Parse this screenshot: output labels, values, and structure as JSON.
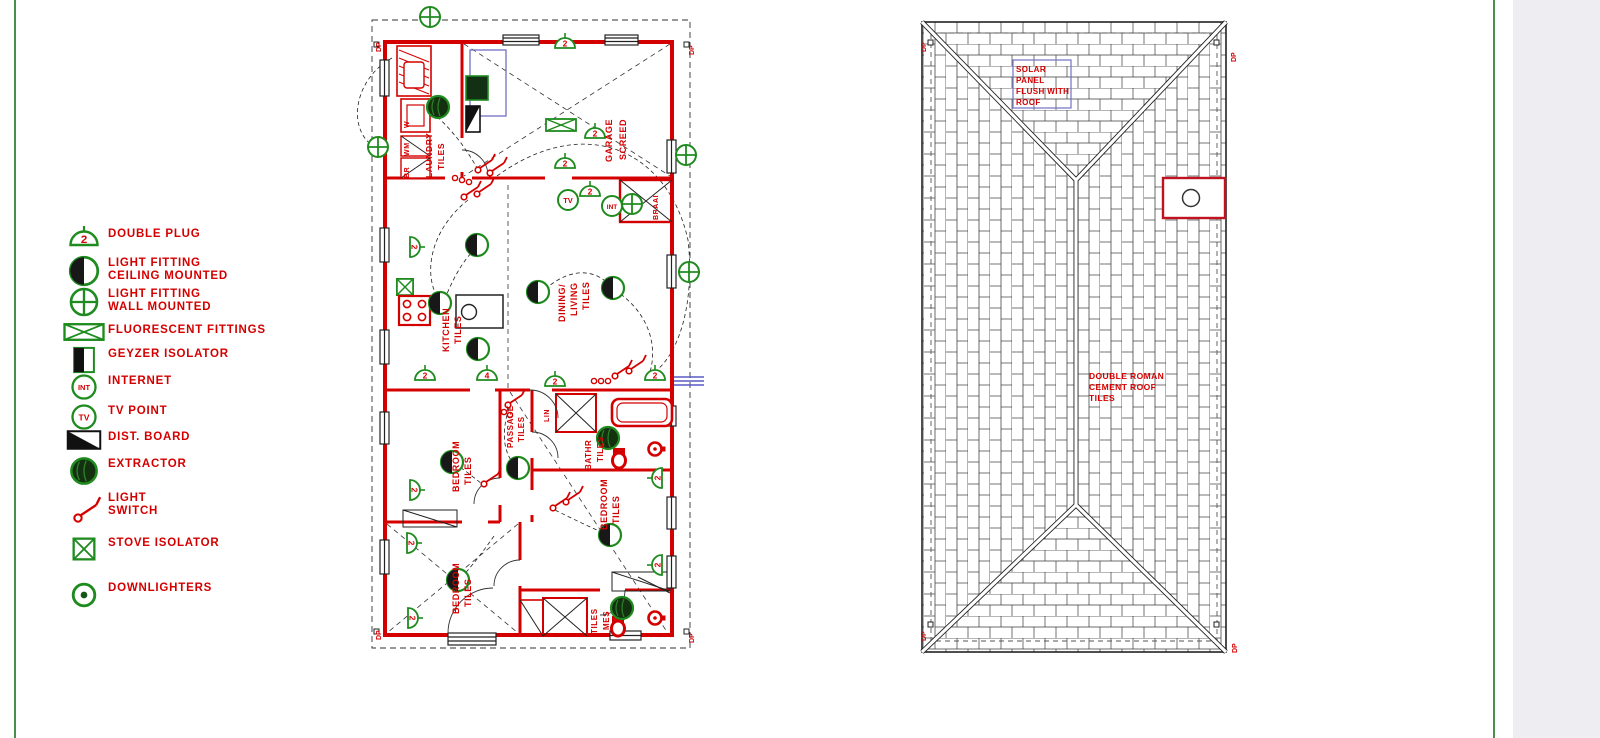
{
  "page": {
    "background": "#ffffff",
    "right_panel_color": "#ededf2",
    "guide_line_color": "#4c8c4c"
  },
  "colors": {
    "red": "#d40000",
    "green": "#1f8b1f",
    "blue": "#7070c0",
    "black": "#222222"
  },
  "legend": {
    "items": [
      {
        "name": "double-plug",
        "label": "DOUBLE PLUG",
        "symbol": "2"
      },
      {
        "name": "light-fitting-ceiling",
        "label": "LIGHT FITTING\nCEILING MOUNTED"
      },
      {
        "name": "light-fitting-wall",
        "label": "LIGHT FITTING\nWALL MOUNTED"
      },
      {
        "name": "fluorescent-fittings",
        "label": "FLUORESCENT FITTINGS"
      },
      {
        "name": "geyzer-isolator",
        "label": "GEYZER ISOLATOR"
      },
      {
        "name": "internet",
        "label": "INTERNET",
        "symbol": "INT"
      },
      {
        "name": "tv-point",
        "label": "TV POINT",
        "symbol": "TV"
      },
      {
        "name": "dist-board",
        "label": "DIST. BOARD"
      },
      {
        "name": "extractor",
        "label": "EXTRACTOR"
      },
      {
        "name": "light-switch",
        "label": "LIGHT\nSWITCH"
      },
      {
        "name": "stove-isolator",
        "label": "STOVE ISOLATOR"
      },
      {
        "name": "downlighters",
        "label": "DOWNLIGHTERS"
      }
    ]
  },
  "floorplan": {
    "dp": "DP",
    "rooms": {
      "laundry": [
        "LAUNDRY",
        "TILES"
      ],
      "appliances": [
        "W",
        "WM",
        "BR"
      ],
      "garage": [
        "GARAGE",
        "SCREED"
      ],
      "braai": [
        "BRAAI"
      ],
      "kitchen": [
        "KITCHEN",
        "TILES"
      ],
      "dining": [
        "DINING/",
        "LIVING",
        "TILES"
      ],
      "bedroom1": [
        "BEDROOM",
        "TILES"
      ],
      "passage": [
        "PASSAGE",
        "TILES"
      ],
      "lin": [
        "LIN"
      ],
      "bathroom": [
        "BATHR",
        "TILES"
      ],
      "bedroom2": [
        "BEDROOM",
        "TILES"
      ],
      "bedroom3": [
        "BEDROOM",
        "TILES"
      ],
      "mes": [
        "TILES",
        "MES"
      ]
    },
    "points": {
      "tv": "TV",
      "int": "INT",
      "plug": "2",
      "plug4": "4"
    }
  },
  "roofplan": {
    "dp": "DP",
    "solar_note": [
      "SOLAR",
      "PANEL",
      "FLUSH WITH",
      "ROOF"
    ],
    "tiles_note": [
      "DOUBLE ROMAN",
      "CEMENT ROOF",
      "TILES"
    ]
  }
}
